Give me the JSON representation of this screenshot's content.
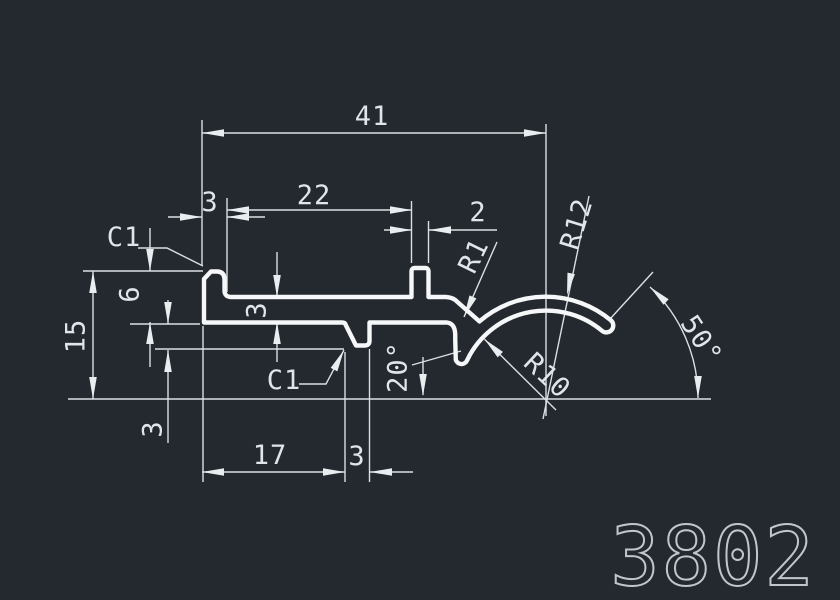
{
  "drawing": {
    "part_number": "3802",
    "colors": {
      "background": "#24282f",
      "profile_outline": "#f5f7f8",
      "dimension_lines": "#d9e0e4",
      "dimension_text": "#dfe5e9",
      "part_number_text": "#bfc7cd"
    },
    "labels": {
      "dim_41": "41",
      "dim_22": "22",
      "dim_3_top": "3",
      "dim_2": "2",
      "chamfer_top": "C1",
      "dim_15": "15",
      "dim_6": "6",
      "dim_3_wall": "3",
      "dim_3_lip": "3",
      "chamfer_notch": "C1",
      "dim_17": "17",
      "dim_3_rib": "3",
      "angle_20": "20°",
      "angle_50": "50°",
      "radius_r1": "R1",
      "radius_r10": "R10",
      "radius_r12": "R12"
    }
  }
}
